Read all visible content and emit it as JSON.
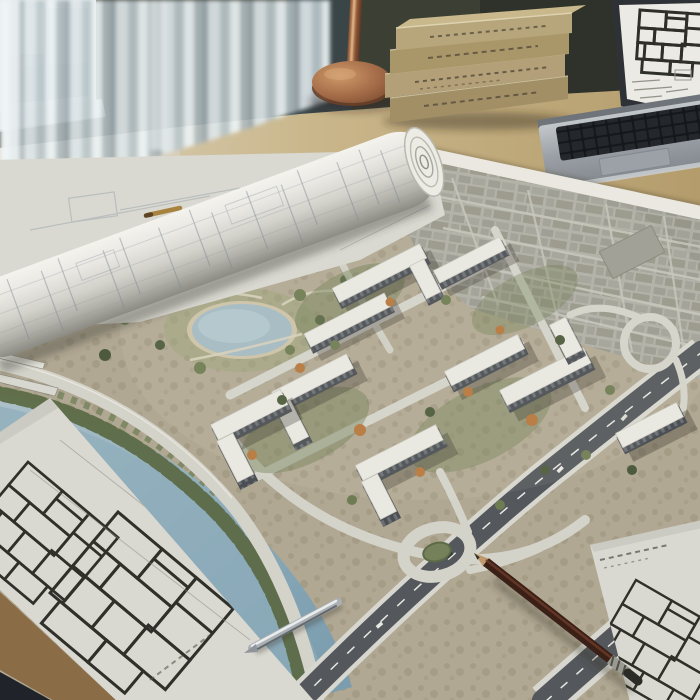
{
  "scene": {
    "type": "photograph",
    "title": "Architect's workspace with urban development site plan",
    "description": "A sunlit wooden desk covered by a large aerial masterplan rendering of a riverside housing development, surrounded by a rolled blueprint, flat floor-plan sheets, a stack of hardcover books, a brass desk lamp, a laptop showing a floor plan, a dark red pencil and a silver pen."
  },
  "objects": {
    "window": {
      "label": "Bright window with sheer white curtains"
    },
    "curtain_dark": {
      "label": "Dark rear curtain panel behind the lamp"
    },
    "desk": {
      "label": "Wooden desk surface"
    },
    "lamp": {
      "label": "Brass desk lamp base and stem"
    },
    "books": {
      "label": "Stack of four tan hardcover books",
      "count": 4
    },
    "laptop": {
      "label": "Aluminum laptop with a floor plan drawing on screen"
    },
    "site_plan": {
      "label": "Aerial site plan of a riverside residential development"
    },
    "pond": {
      "label": "Oval park pond with footpaths"
    },
    "river": {
      "label": "Tree-lined river crossing the plan diagonally"
    },
    "highway": {
      "label": "Multi-lane highway with interchange and loop ramp"
    },
    "roundabout": {
      "label": "Road roundabout with green island"
    },
    "buildings": {
      "label": "Mid-rise apartment blocks with pale roofs",
      "count": 9
    },
    "city_grid": {
      "label": "Existing low-rise grey city fabric"
    },
    "blueprint_roll": {
      "label": "Rolled blueprint lying across the plans"
    },
    "flat_sheet": {
      "label": "Flat blueprint sheet with faint map linework"
    },
    "sheet_left": {
      "label": "Floor-plan sheet at bottom left"
    },
    "sheet_right": {
      "label": "Floor-plan sheet at bottom right"
    },
    "pencil": {
      "label": "Dark red pencil with metal ferrule"
    },
    "silver_pen": {
      "label": "Silver pen lying on the floor-plan sheet"
    },
    "gold_pen": {
      "label": "Small brass pen on the flat sheet"
    },
    "rulers": {
      "label": "Metal straightedge tips at the left edge"
    }
  },
  "palette": {
    "wall": "#3c4034",
    "wallDark": "#2e322a",
    "windowFrame": "#e6ebec",
    "windowPane": "#c6d1d5",
    "curtainDark": "#3a4548",
    "desk": "#c8b488",
    "deskDark": "#a89064",
    "wood": "#8a6c46",
    "cornerDark": "#20242a",
    "paper": "#dad9d1",
    "ink": "#32322c",
    "faintInk": "#9fa8b0",
    "mapMargin": "#eae8e0",
    "ground": "#b1a893",
    "city": "#a8a79d",
    "road": "#d4d3ca",
    "asphalt": "#54585c",
    "water": "#9db6c0",
    "waterDeep": "#7e9dae",
    "bank": "#5c6a46",
    "green": "#6e7c52",
    "greenDark": "#4d5b3c",
    "roof": "#e9e8e1",
    "facade": "#4b4f53",
    "autumn": "#b5773c",
    "copper": "#a06845",
    "bookTan": "#b2a077",
    "aluminum": "#a3a9ae",
    "keys": "#1d2125",
    "screen": "#ebeae4",
    "pencilBody": "#3c2014",
    "silver": "#b9bfc2"
  }
}
